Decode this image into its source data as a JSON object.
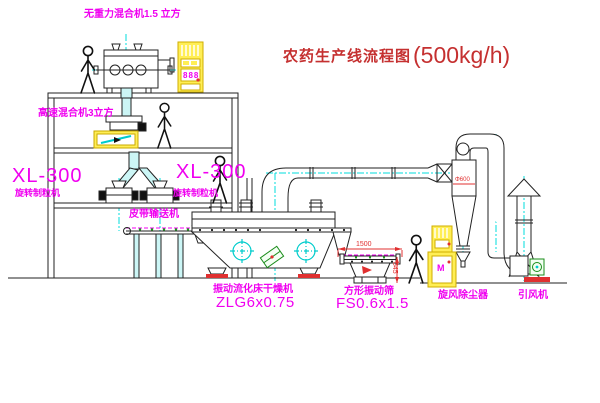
{
  "title": {
    "text": "农药生产线流程图",
    "capacity": "(500kg/h)"
  },
  "labels": {
    "gravity_mixer": "无重力混合机1.5 立方",
    "high_speed_mixer": "高速混合机3立方",
    "granulator_left": {
      "model": "XL-300",
      "name": "旋转制粒机"
    },
    "granulator_right": {
      "model": "XL-300",
      "name": "旋转制粒机"
    },
    "belt_conveyor": "皮带输送机",
    "dryer": {
      "name": "振动流化床干燥机",
      "model": "ZLG6x0.75"
    },
    "sieve": {
      "name": "方形振动筛",
      "model": "FS0.6x1.5"
    },
    "cyclone": "旋风除尘器",
    "fan": "引风机"
  },
  "dimensions": {
    "sieve_length": "1500",
    "sieve_height": "545",
    "cyclone_diameter": "Φ600"
  },
  "cabinets": {
    "top_display": "888",
    "right_display": "M"
  },
  "colors": {
    "label_magenta": "#f000f0",
    "title_red": "#c53030",
    "centerline_cyan": "#00dcdc",
    "cabinet_yellow": "#ffee55",
    "dimension_red": "#e03030",
    "line_black": "#222222"
  }
}
